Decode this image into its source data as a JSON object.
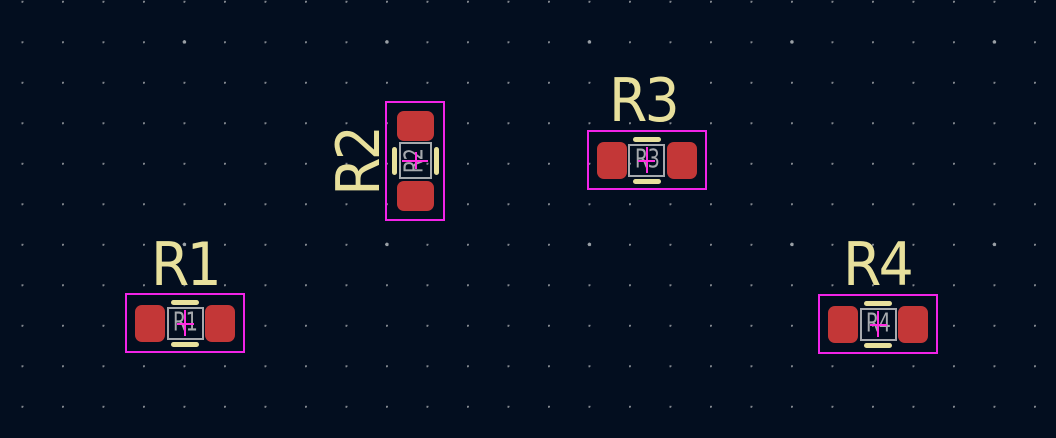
{
  "app": {
    "view": "pcb-editor-canvas",
    "canvas_width": 1056,
    "canvas_height": 438
  },
  "colors": {
    "background": "#030e1f",
    "grid_dot": "#82878e",
    "grid_major_dot": "#9aa0a6",
    "copper_pad": "#c33737",
    "silkscreen": "#e8e09c",
    "fab_layer": "#a6a9ad",
    "courtyard": "#f224e8",
    "anchor_cross": "#ff2ce0"
  },
  "grid": {
    "minor_spacing_px": 40.5,
    "major_every": 5,
    "style": "dots"
  },
  "footprints": [
    {
      "reference": "R1",
      "fab_text": "R1",
      "center_x": 185,
      "center_y": 323,
      "rotation_deg": 0,
      "label": {
        "text": "R1",
        "x": 185,
        "y": 265.5,
        "rotation_deg": 0
      }
    },
    {
      "reference": "R2",
      "fab_text": "R2",
      "center_x": 414.7,
      "center_y": 161,
      "rotation_deg": -90,
      "label": {
        "text": "R2",
        "x": 358.5,
        "y": 162.5,
        "rotation_deg": -90
      }
    },
    {
      "reference": "R3",
      "fab_text": "R3",
      "center_x": 646.7,
      "center_y": 160.2,
      "rotation_deg": 0,
      "label": {
        "text": "R3",
        "x": 643.3,
        "y": 101.7,
        "rotation_deg": 0
      }
    },
    {
      "reference": "R4",
      "fab_text": "R4",
      "center_x": 878.3,
      "center_y": 324.2,
      "rotation_deg": 0,
      "label": {
        "text": "R4",
        "x": 876.7,
        "y": 265.8,
        "rotation_deg": 0
      }
    }
  ]
}
